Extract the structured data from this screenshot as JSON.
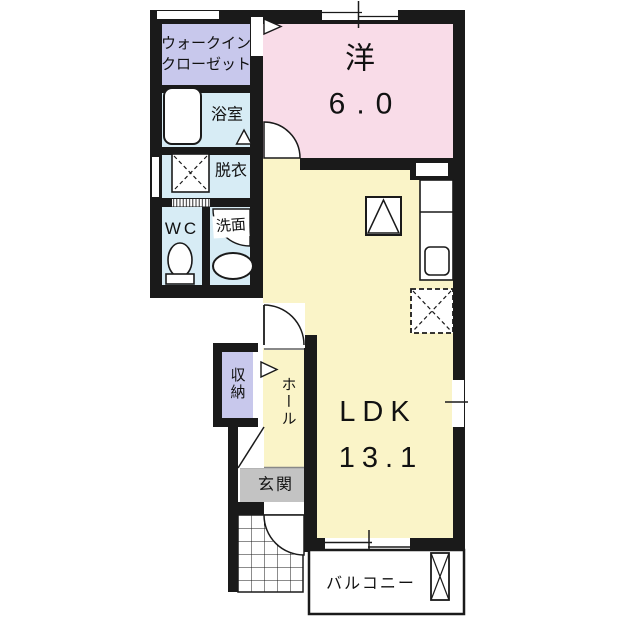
{
  "floorplan": {
    "type": "japanese-apartment-floor-plan",
    "wall_color": "#1a1a1a",
    "rooms": {
      "wic": {
        "label_line1": "ウォークイン",
        "label_line2": "クローゼット",
        "color": "#c8c8ec"
      },
      "bathroom": {
        "label": "浴室",
        "color": "#d7ecf5"
      },
      "dressing_room": {
        "label": "脱衣",
        "color": "#d7ecf5"
      },
      "toilet_room": {
        "label": "WC",
        "color": "#d7ecf5"
      },
      "washroom": {
        "label": "洗面",
        "color": "#d7ecf5"
      },
      "western_room": {
        "label": "洋",
        "size": "6.0",
        "color": "#f9dce8"
      },
      "ldk": {
        "label": "LDK",
        "size": "13.1",
        "color": "#faf4c8"
      },
      "storage": {
        "label": "収納",
        "color": "#c8c8ec"
      },
      "hall": {
        "label": "ホール",
        "color": "#faf4c8"
      },
      "entrance": {
        "label": "玄関",
        "color": "#c3c3c3"
      },
      "balcony": {
        "label": "バルコニー",
        "color": "#ffffff"
      }
    }
  }
}
